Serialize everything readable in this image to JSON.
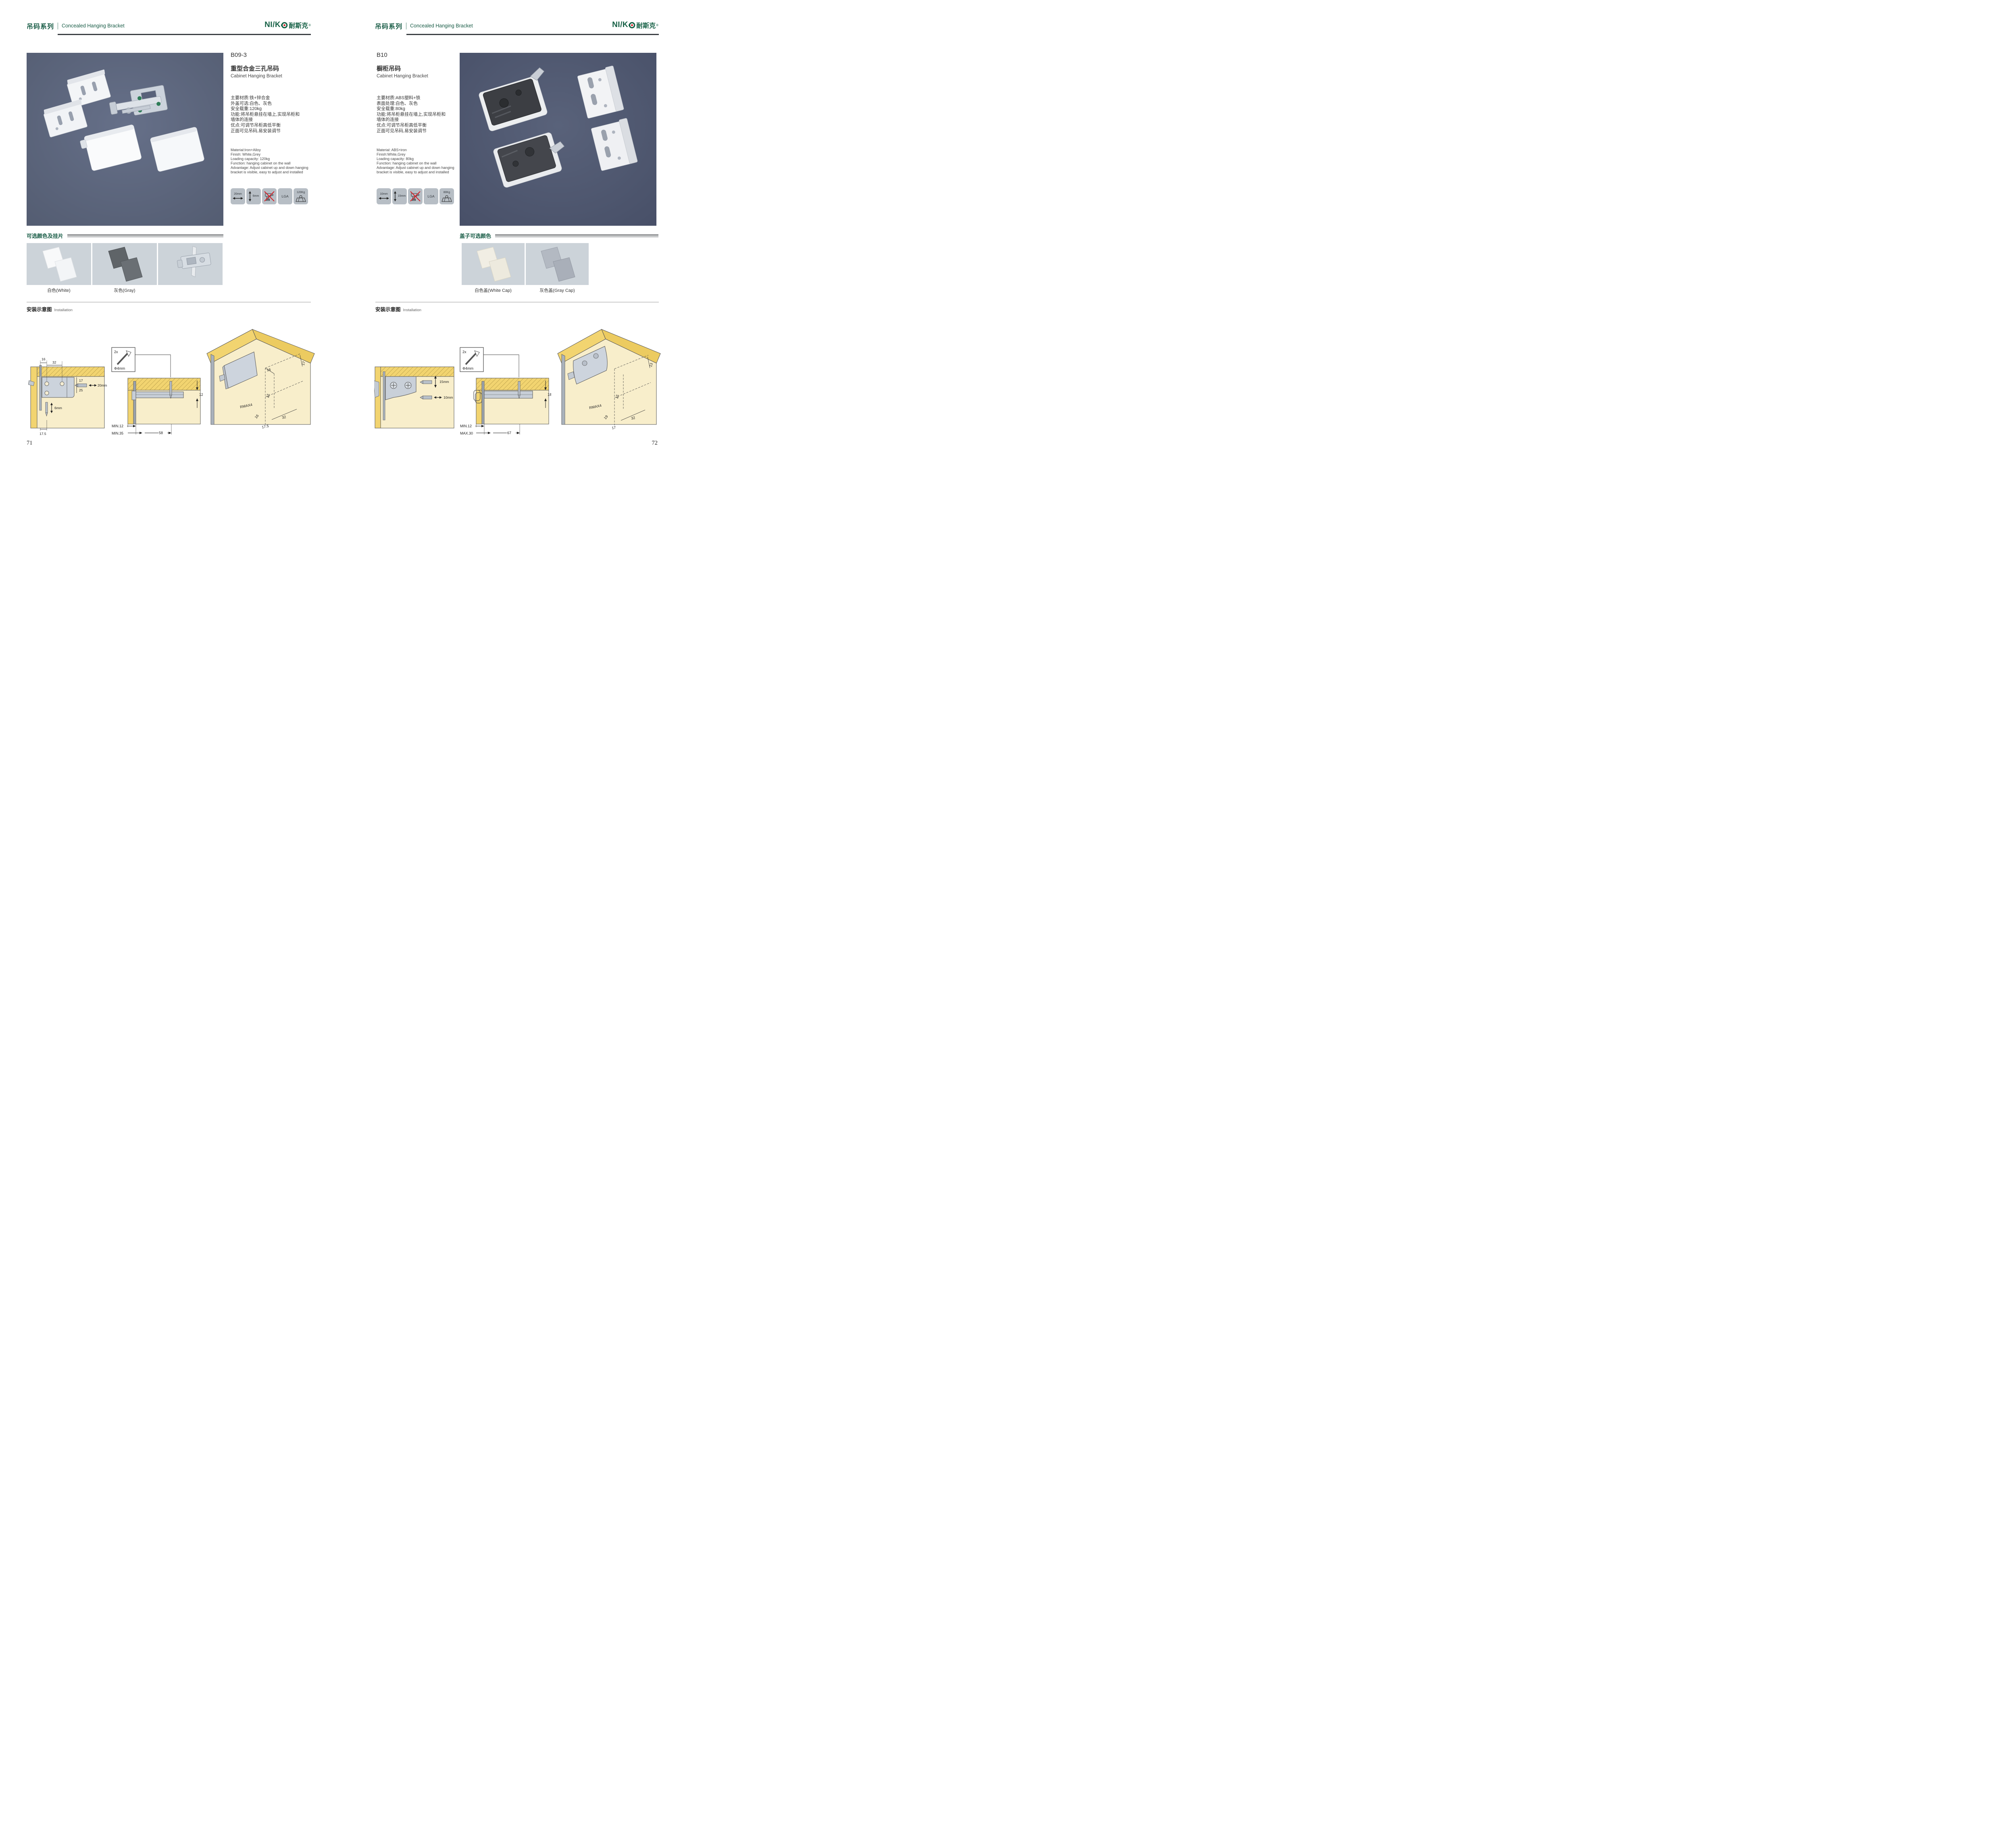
{
  "brand": {
    "latin": "NI/K",
    "cn": "耐斯克",
    "reg": "®",
    "green": "#156045",
    "red": "#d31f26"
  },
  "colors": {
    "brand_green": "#175b45",
    "photo_bg_left": "#5a6377",
    "photo_bg_right": "#4e5669",
    "swatch_bg": "#ccd3d9",
    "badge_bg": "#b7bec5",
    "wood_dark": "#f2d470",
    "wood_light": "#f8eecb",
    "steel": "#ccd3dc",
    "no_drill_red": "#d2232a"
  },
  "pages": [
    {
      "header": {
        "series_cn": "吊码系列",
        "series_en": "Concealed Hanging Bracket"
      },
      "product": {
        "model": "B09-3",
        "name_cn": "重型合金三孔吊码",
        "name_en": "Cabinet Hanging Bracket",
        "specs_cn": [
          "主要材质:铁+锌合金",
          "外盖可选:白色、灰色",
          "安全载重:120kg",
          "功能:将吊柜悬挂在墙上,实现吊柜和",
          "墙体的连接",
          "优点:可调节吊柜高低平衡",
          "正面可见吊码,易安装调节"
        ],
        "specs_en": [
          "Material:Iron+Alloy",
          "Finish: White,Grey",
          "Loading capacity: 120kg",
          "Function: hanging cabinet on the wall",
          "Advantage: Adjust cabinet up and down hanging",
          "bracket is visible, easy to adjust and installed"
        ],
        "badges": [
          {
            "icon": "width-arrow-icon",
            "label": "20mm"
          },
          {
            "icon": "height-arrow-icon",
            "label": "6mm"
          },
          {
            "icon": "no-drill-icon",
            "label": ""
          },
          {
            "icon": "none",
            "label": "LGA"
          },
          {
            "icon": "weight-icon",
            "label": "120Kg"
          }
        ]
      },
      "colors_section": {
        "title": "可选颜色及挂片",
        "labels": [
          "白色(White)",
          "灰色(Gray)",
          ""
        ]
      },
      "installation": {
        "title_cn": "安装示意图",
        "title_en": "Installation",
        "d1": {
          "top_a": "16",
          "top_b": "32",
          "right_a": "17",
          "right_b": "25",
          "bit": "20mm",
          "depth": "6mm",
          "bottom": "17.5"
        },
        "d2": {
          "count": "2x",
          "dia": "Φ4mm",
          "side": "12",
          "min1": "MIN.12",
          "min2": "MIN.35",
          "span": "58"
        },
        "d3": {
          "top": "16",
          "right": "17",
          "height": "42",
          "radius": "RMAX4",
          "a": "16",
          "b": "32",
          "c": "17.5"
        }
      },
      "page_number": "71"
    },
    {
      "header": {
        "series_cn": "吊码系列",
        "series_en": "Concealed Hanging Bracket"
      },
      "product": {
        "model": "B10",
        "name_cn": "橱柜吊码",
        "name_en": "Cabinet Hanging Bracket",
        "specs_cn": [
          "主要材质:ABS塑料+铁",
          "表面处理:白色、灰色",
          "安全载重:80kg",
          "功能:将吊柜悬挂在墙上,实现吊柜和",
          "墙体的连接",
          "优点:可调节吊柜高低平衡",
          "正面可见吊码,易安装调节"
        ],
        "specs_en": [
          "Material: ABS+iron",
          "Finish:White,Grey",
          "Loading capacity: 80kg",
          "Function: hanging cabinet on the wall",
          "Advantage: Adjust cabinet up and down hanging",
          "bracket is visible, easy to adjust and installed"
        ],
        "badges": [
          {
            "icon": "width-arrow-icon",
            "label": "10mm"
          },
          {
            "icon": "height-arrow-icon",
            "label": "15mm"
          },
          {
            "icon": "no-drill-icon",
            "label": ""
          },
          {
            "icon": "none",
            "label": "LGA"
          },
          {
            "icon": "weight-icon",
            "label": "80Kg"
          }
        ]
      },
      "colors_section": {
        "title": "盖子可选颜色",
        "labels": [
          "白色盖(White Cap)",
          "灰色盖(Gray Cap)"
        ]
      },
      "installation": {
        "title_cn": "安装示意图",
        "title_en": "Installation",
        "d1": {
          "v": "15mm",
          "h": "10mm"
        },
        "d2": {
          "count": "2x",
          "dia": "Φ4mm",
          "side": "18",
          "min1": "MIN.12",
          "min2": "MAX.30",
          "span": "67"
        },
        "d3": {
          "right": "13",
          "height": "42",
          "radius": "RMAX4",
          "a": "19",
          "b": "32",
          "c": "17"
        }
      },
      "page_number": "72"
    }
  ]
}
